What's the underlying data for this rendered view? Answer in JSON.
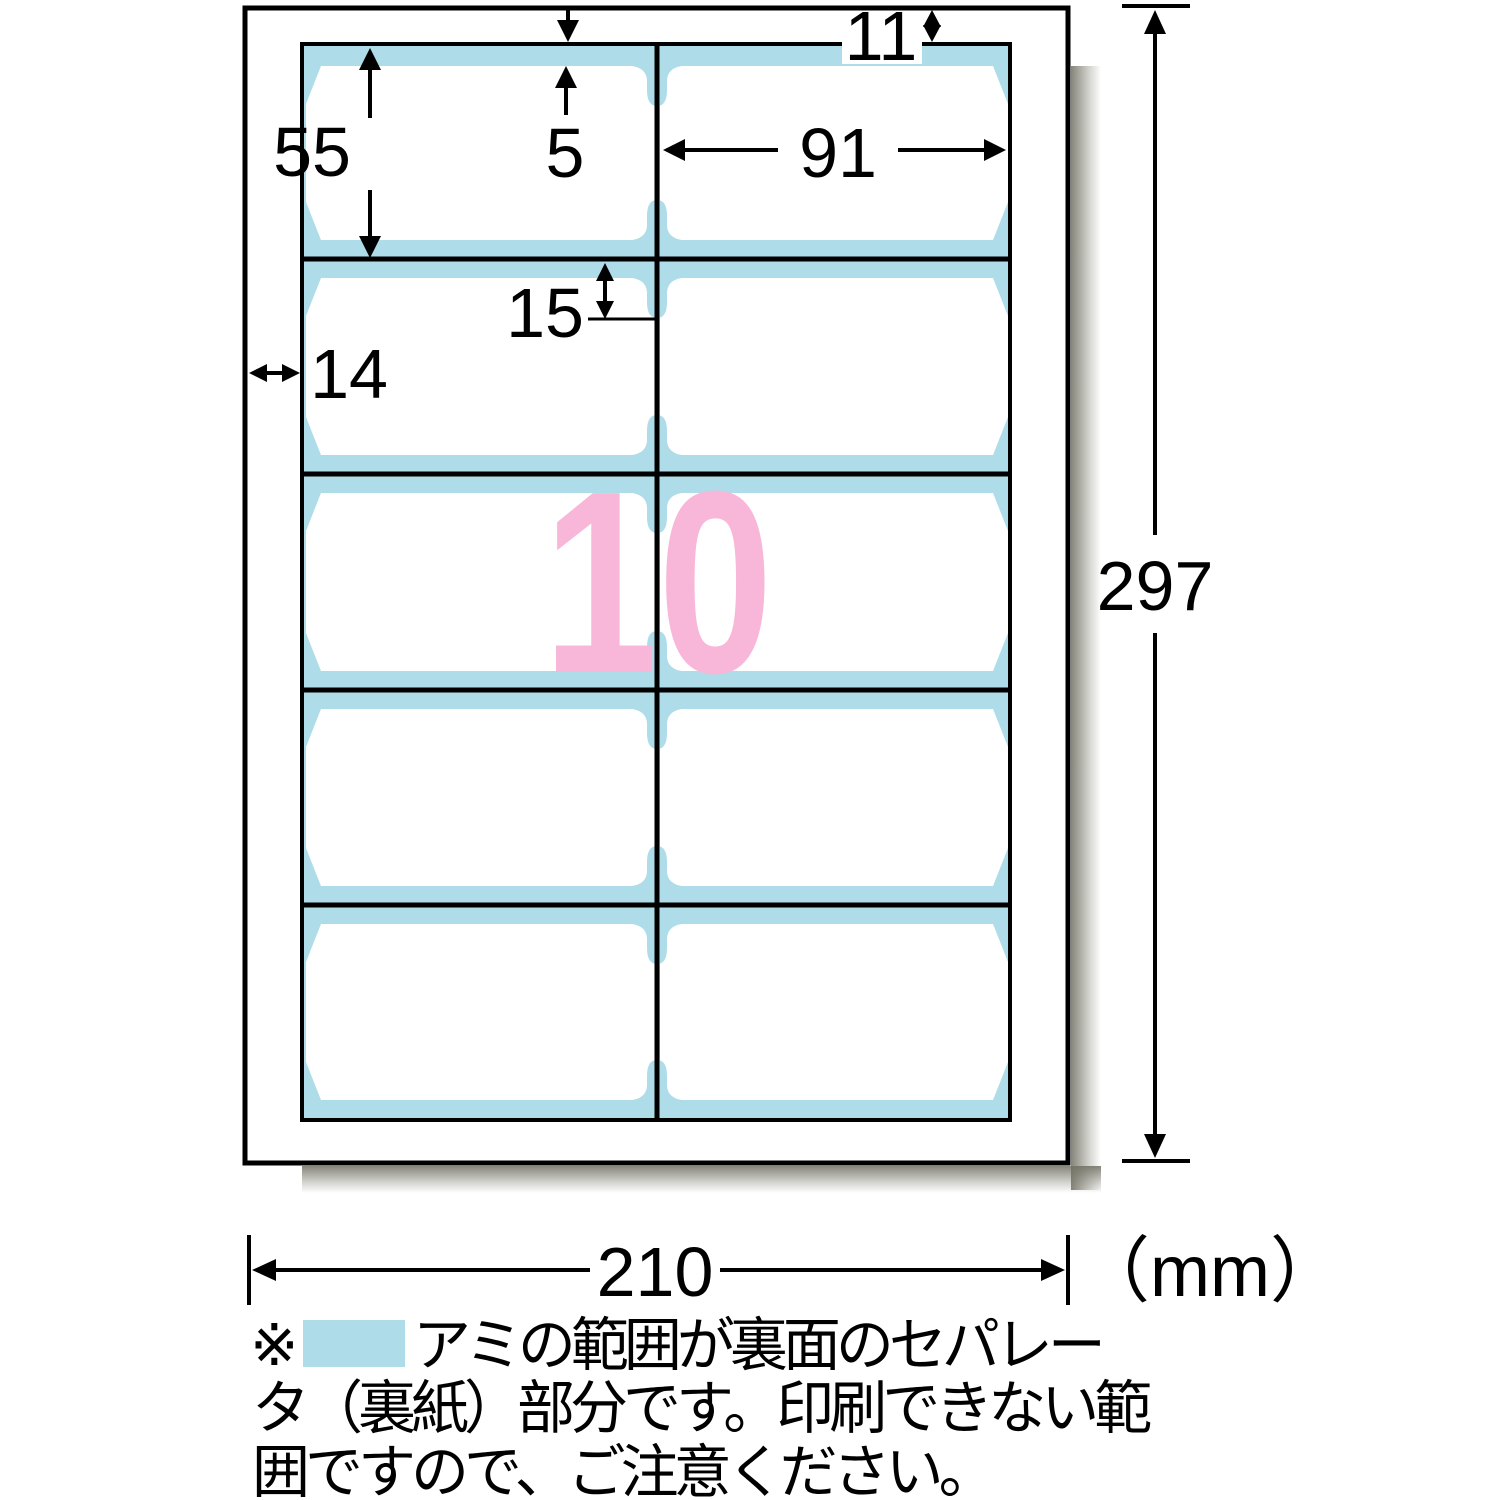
{
  "diagram": {
    "sheet_count": "10",
    "unit_label": "（mm）",
    "dimensions": {
      "page_width": "210",
      "page_height": "297",
      "top_margin": "11",
      "left_margin": "14",
      "card_width": "91",
      "card_height": "55",
      "edge_gap": "5",
      "separator_overlap": "15"
    },
    "colors": {
      "separator_blue": "#aedde9",
      "count_pink": "#f8b7d8",
      "line_black": "#000000"
    },
    "note": {
      "marker": "※",
      "line1": "アミの範囲が裏面のセパレー",
      "line2": "タ（裏紙）部分です。印刷できない範",
      "line3": "囲ですので、ご注意ください。"
    }
  }
}
